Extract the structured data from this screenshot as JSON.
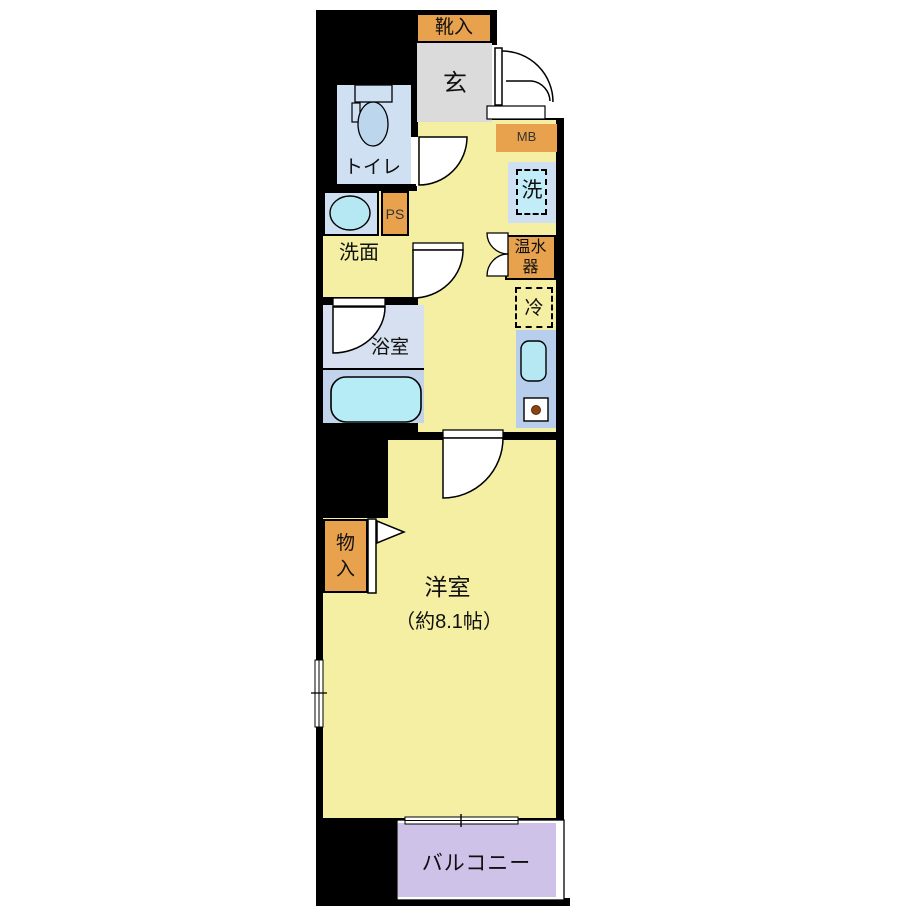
{
  "plan": {
    "type": "apartment-floorplan",
    "rooms": {
      "shoe_cabinet": "靴入",
      "entrance": "玄",
      "meter_box": "MB",
      "toilet": "トイレ",
      "pipe_space": "PS",
      "washroom": "洗面",
      "washing_machine": "洗",
      "water_heater_l1": "温水",
      "water_heater_l2": "器",
      "refrigerator": "冷",
      "bathroom": "浴室",
      "closet_l1": "物",
      "closet_l2": "入",
      "western_room": "洋室",
      "western_room_size": "（約8.1帖）",
      "balcony": "バルコニー"
    },
    "colors": {
      "wall_black": "#000000",
      "floor_yellow": "#f4efa3",
      "accent_orange": "#e8a24d",
      "entrance_gray": "#dbdbdb",
      "water_blue": "#cfe0f2",
      "bath_upper_blue": "#d6e0f0",
      "bath_lower_blue": "#c2d4ec",
      "fixture_cyan": "#b6e8f4",
      "kitchen_counter_blue": "#b7cfec",
      "balcony_purple": "#cfc2e9"
    }
  }
}
